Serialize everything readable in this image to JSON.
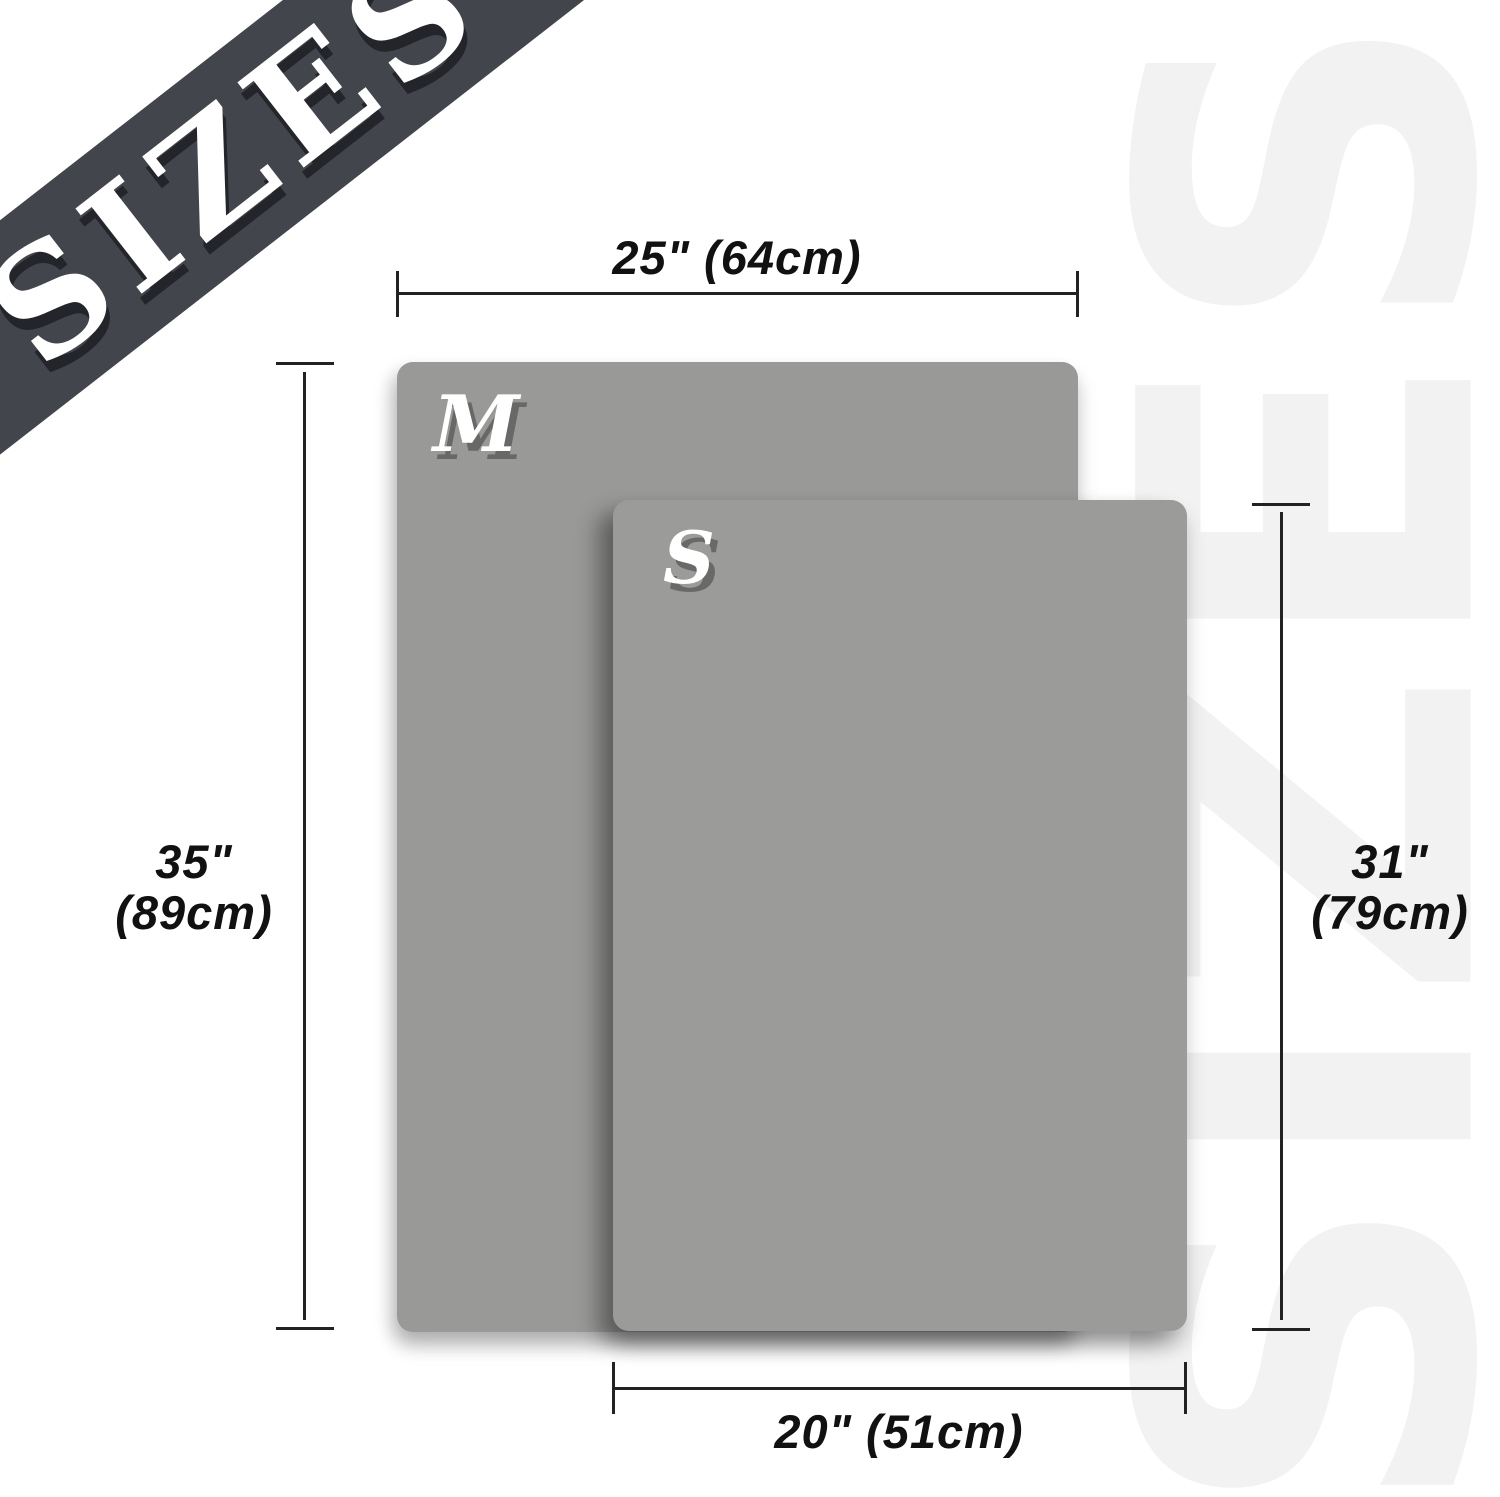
{
  "banner": {
    "label": "SIZES"
  },
  "watermark": {
    "label": "SIZES"
  },
  "sizes": [
    {
      "id": "M",
      "letter": "M",
      "width_label": "25\" (64cm)",
      "height_label_inches": "35\"",
      "height_label_cm": "(89cm)"
    },
    {
      "id": "S",
      "letter": "S",
      "width_label": "20\" (51cm)",
      "height_label_inches": "31\"",
      "height_label_cm": "(79cm)"
    }
  ],
  "colors": {
    "ribbon": "#43454c",
    "ribbon_text": "#ffffff",
    "mat_fill": "#999998",
    "watermark": "#f2f2f2",
    "dimension_line": "#222222",
    "dimension_text": "#111111"
  }
}
